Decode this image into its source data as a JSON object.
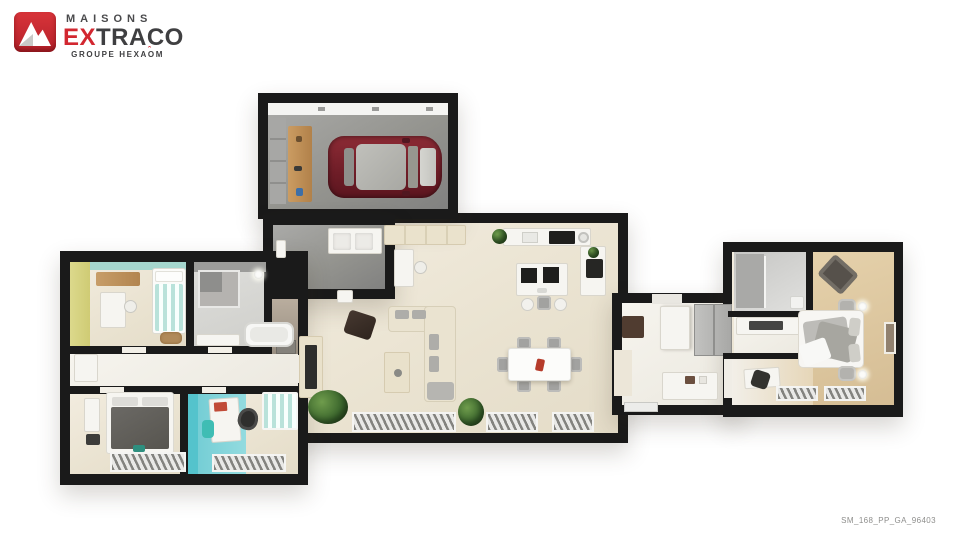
{
  "brand": {
    "maisons": "MAISONS",
    "ex": "EX",
    "traco": "TRACO",
    "group_left": "GROUPE HEXA",
    "group_o": "O",
    "group_caret": "ˆ",
    "group_right": "M"
  },
  "footer": {
    "plan_code": "SM_168_PP_GA_96403"
  },
  "palette": {
    "wall_black": "#1a1a1a",
    "floor_cream": "#ece6d8",
    "concrete_gray": "#949492",
    "bedroom_tan": "#dcc5a0",
    "accent_cyan": "#7ed2d8",
    "accent_mint": "#bfe4dd",
    "accent_yellow_green": "#dbd688",
    "car_red": "#7a222c",
    "logo_red": "#d22730",
    "logo_dark": "#3f3f41"
  },
  "icons": {
    "logo": "extraco-mountain-logo"
  }
}
